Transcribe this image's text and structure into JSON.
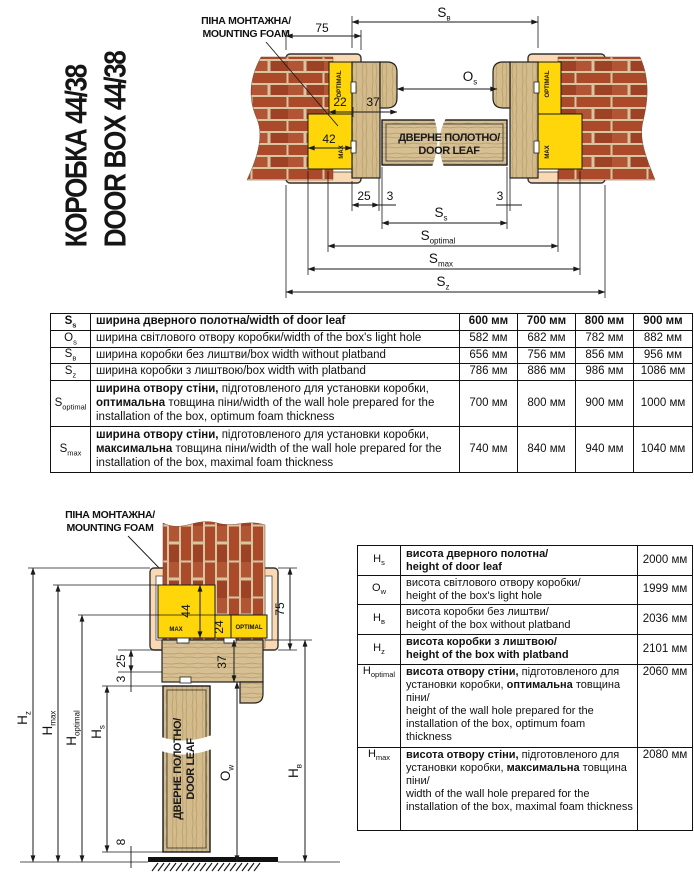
{
  "title": {
    "line1": "КОРОБКА 44/38",
    "line2": "DOOR BOX 44/38"
  },
  "labels": {
    "mounting_foam_ua": "ПІНА МОНТАЖНА/",
    "mounting_foam_en": "MOUNTING FOAM",
    "door_leaf_ua": "ДВЕРНЕ ПОЛОТНО/",
    "door_leaf_en": "DOOR LEAF",
    "foam_optimal": "OPTIMAL",
    "foam_max": "MAX"
  },
  "top_diagram": {
    "dims": {
      "platband": "75",
      "foam_opt": "22",
      "box_profile": "37",
      "foam_max": "42",
      "box_face": "25",
      "gap_left": "3",
      "gap_right": "3"
    },
    "dim_labels": {
      "sb": {
        "main": "S",
        "sub": "в"
      },
      "os": {
        "main": "O",
        "sub": "s"
      },
      "ss": {
        "main": "S",
        "sub": "s"
      },
      "soptimal": {
        "main": "S",
        "sub": "optimal"
      },
      "smax": {
        "main": "S",
        "sub": "max"
      },
      "sz": {
        "main": "S",
        "sub": "z"
      }
    }
  },
  "bottom_diagram": {
    "dims": {
      "platband": "75",
      "foam_max": "44",
      "foam_opt": "24",
      "box_profile": "37",
      "box_face": "25",
      "gap_top": "3",
      "floor_gap": "8"
    },
    "dim_labels": {
      "hz": {
        "main": "H",
        "sub": "z"
      },
      "hmax": {
        "main": "H",
        "sub": "max"
      },
      "hoptimal": {
        "main": "H",
        "sub": "optimal"
      },
      "hs": {
        "main": "H",
        "sub": "s"
      },
      "ow": {
        "main": "O",
        "sub": "w"
      },
      "hb": {
        "main": "H",
        "sub": "в"
      }
    }
  },
  "table1": {
    "rows": [
      {
        "sym": "S",
        "sub": "s",
        "d_b1": "ширина дверного полотна/width of door leaf",
        "values": [
          "600 мм",
          "700 мм",
          "800 мм",
          "900 мм"
        ]
      },
      {
        "sym": "O",
        "sub": "s",
        "d_r1": "ширина світлового отвору коробки/width of the box's light hole",
        "values": [
          "582 мм",
          "682 мм",
          "782 мм",
          "882 мм"
        ]
      },
      {
        "sym": "S",
        "sub": "в",
        "d_r1": "ширина коробки без лиштви/box width without platband",
        "values": [
          "656 мм",
          "756 мм",
          "856 мм",
          "956 мм"
        ]
      },
      {
        "sym": "S",
        "sub": "z",
        "d_r1": "ширина коробки з лиштвою/box width with platband",
        "values": [
          "786 мм",
          "886 мм",
          "986 мм",
          "1086 мм"
        ]
      },
      {
        "sym": "S",
        "sub": "optimal",
        "d_b1": "ширина отвору стіни,",
        "d_r1": " підготовленого для установки коробки, ",
        "d_b2": "оптимальна",
        "d_r2": " товщина піни/width of the wall hole prepared for the installation of the box, optimum foam thickness",
        "values": [
          "700 мм",
          "800 мм",
          "900 мм",
          "1000 мм"
        ]
      },
      {
        "sym": "S",
        "sub": "max",
        "d_b1": "ширина отвору стіни,",
        "d_r1": " підготовленого для установки коробки, ",
        "d_b2": "максимальна",
        "d_r2": " товщина піни/width of the wall hole prepared for the installation of the box, maximal foam thickness",
        "values": [
          "740 мм",
          "840 мм",
          "940 мм",
          "1040 мм"
        ]
      }
    ]
  },
  "table2": {
    "rows": [
      {
        "sym": "H",
        "sub": "s",
        "d_b1": "висота дверного полотна/\nheight of door leaf",
        "value": "2000 мм"
      },
      {
        "sym": "O",
        "sub": "w",
        "d_r1": "висота світлового отвору коробки/\nheight of the box's light hole",
        "value": "1999 мм"
      },
      {
        "sym": "H",
        "sub": "в",
        "d_r1": "висота коробки без лиштви/\nheight of the box without platband",
        "value": "2036 мм"
      },
      {
        "sym": "H",
        "sub": "z",
        "d_b1": "висота коробки з лиштвою/\nheight of the box with platband",
        "value": "2101 мм"
      },
      {
        "sym": "H",
        "sub": "optimal",
        "d_b1": "висота отвору стіни,",
        "d_r1": " підготовленого для установки коробки, ",
        "d_b2": "оптимальна",
        "d_r2": " товщина піни/\nheight of the wall hole prepared for the installation of the box, optimum foam thickness",
        "value": "2060 мм"
      },
      {
        "sym": "H",
        "sub": "max",
        "d_b1": "висота отвору стіни,",
        "d_r1": " підготовленого для установки коробки, ",
        "d_b2": "максимальна",
        "d_r2": " товщина піни/\nwidth of the wall hole prepared for the installation of the box, maximal foam thickness",
        "value": "2080 мм"
      }
    ]
  },
  "colors": {
    "foam": "#ffd60a",
    "platband": "#f8d9b4",
    "wood": "#d3bb8c",
    "brick": "#aa4a2b",
    "mortar": "#d7c5a0",
    "line": "#1a1a1a"
  }
}
